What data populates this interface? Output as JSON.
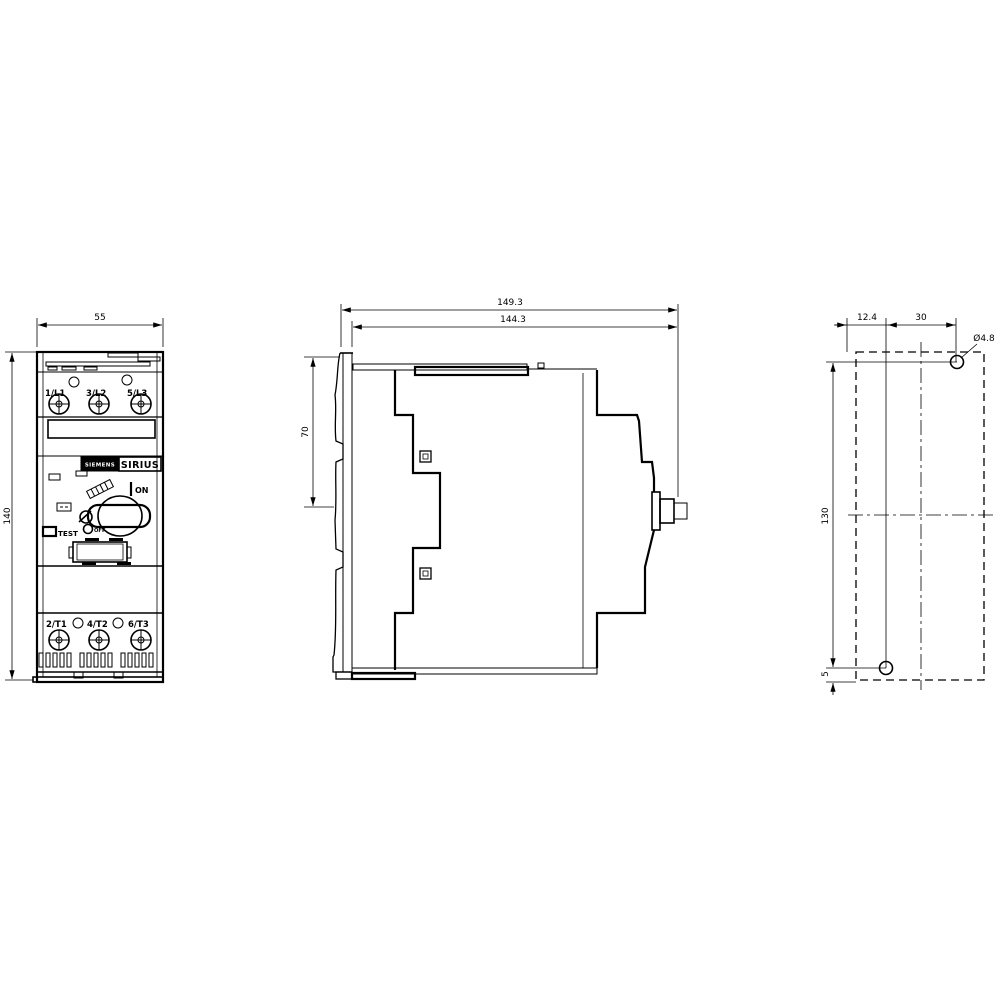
{
  "front": {
    "width_dim": "55",
    "height_dim": "140",
    "top_terminals": [
      "1/L1",
      "3/L2",
      "5/L3"
    ],
    "bottom_terminals": [
      "2/T1",
      "4/T2",
      "6/T3"
    ],
    "brand_primary": "SIEMENS",
    "brand_series": "SIRIUS",
    "on_label": "ON",
    "off_label": "OFF",
    "test_label": "TEST"
  },
  "side": {
    "total_depth_dim": "149.3",
    "body_depth_dim": "144.3",
    "upper_depth_dim": "70"
  },
  "plan": {
    "hole_offset_x_dim": "12.4",
    "hole_spacing_x_dim": "30",
    "hole_diameter_label": "Ø4.8",
    "hole_spacing_y_dim": "130",
    "bottom_offset_dim": "5"
  },
  "colors": {
    "line": "#000000",
    "background": "#ffffff"
  }
}
